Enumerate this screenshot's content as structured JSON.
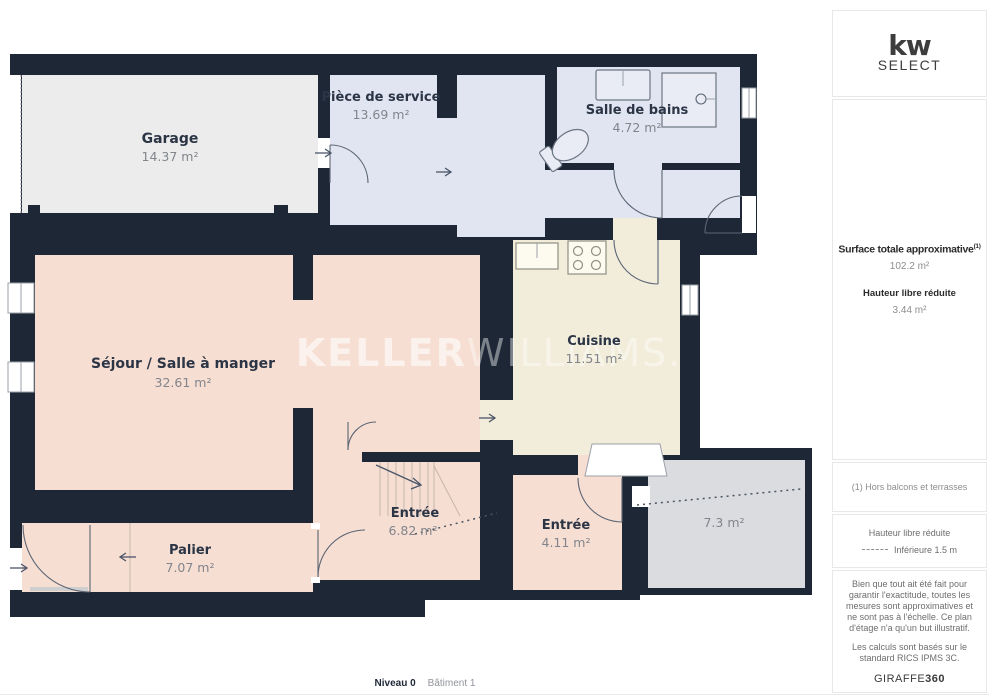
{
  "branding": {
    "logo_primary": "kw",
    "logo_secondary": "SELECT",
    "watermark_bold": "KELLER",
    "watermark_light": "WILLIAMS."
  },
  "sidebar": {
    "surface_block": {
      "title": "Surface totale approximative",
      "title_ref": "(1)",
      "value": "102.2 m²",
      "subtitle": "Hauteur libre réduite",
      "subvalue": "3.44 m²"
    },
    "footnote": "(1) Hors balcons et terrasses",
    "legend": {
      "title": "Hauteur libre réduite",
      "item": "Inférieure 1.5 m"
    },
    "disclaimer_lines": [
      "Bien que tout ait été fait pour garantir l'exactitude, toutes les mesures sont approximatives et ne sont pas à l'échelle. Ce plan d'étage n'a qu'un but illustratif.",
      "Les calculs sont basés sur le standard RICS IPMS 3C."
    ],
    "brand": {
      "name": "GIRAFFE",
      "suffix": "360"
    }
  },
  "floorplan": {
    "rooms": [
      {
        "name": "Garage",
        "area": "14.37 m²"
      },
      {
        "name": "Pièce de service",
        "area": "13.69 m²"
      },
      {
        "name": "Salle de bains",
        "area": "4.72 m²"
      },
      {
        "name": "Séjour / Salle à manger",
        "area": "32.61 m²"
      },
      {
        "name": "Cuisine",
        "area": "11.51 m²"
      },
      {
        "name": "Entrée",
        "area": "6.82 m²"
      },
      {
        "name": "Entrée",
        "area": "4.11 m²"
      },
      {
        "name": "Palier",
        "area": "7.07 m²"
      },
      {
        "name": "",
        "area": "7.3 m²"
      }
    ],
    "colors": {
      "wall": "#1d2735",
      "room_pink": "#f6ded2",
      "room_lavender": "#e1e5f1",
      "room_cream": "#f2ecda",
      "room_gray_light": "#ececec",
      "room_gray": "#dbdce0",
      "label_dark": "#2b3545",
      "label_muted": "#82858c"
    }
  },
  "footer": {
    "level": "Niveau 0",
    "building": "Bâtiment 1"
  }
}
